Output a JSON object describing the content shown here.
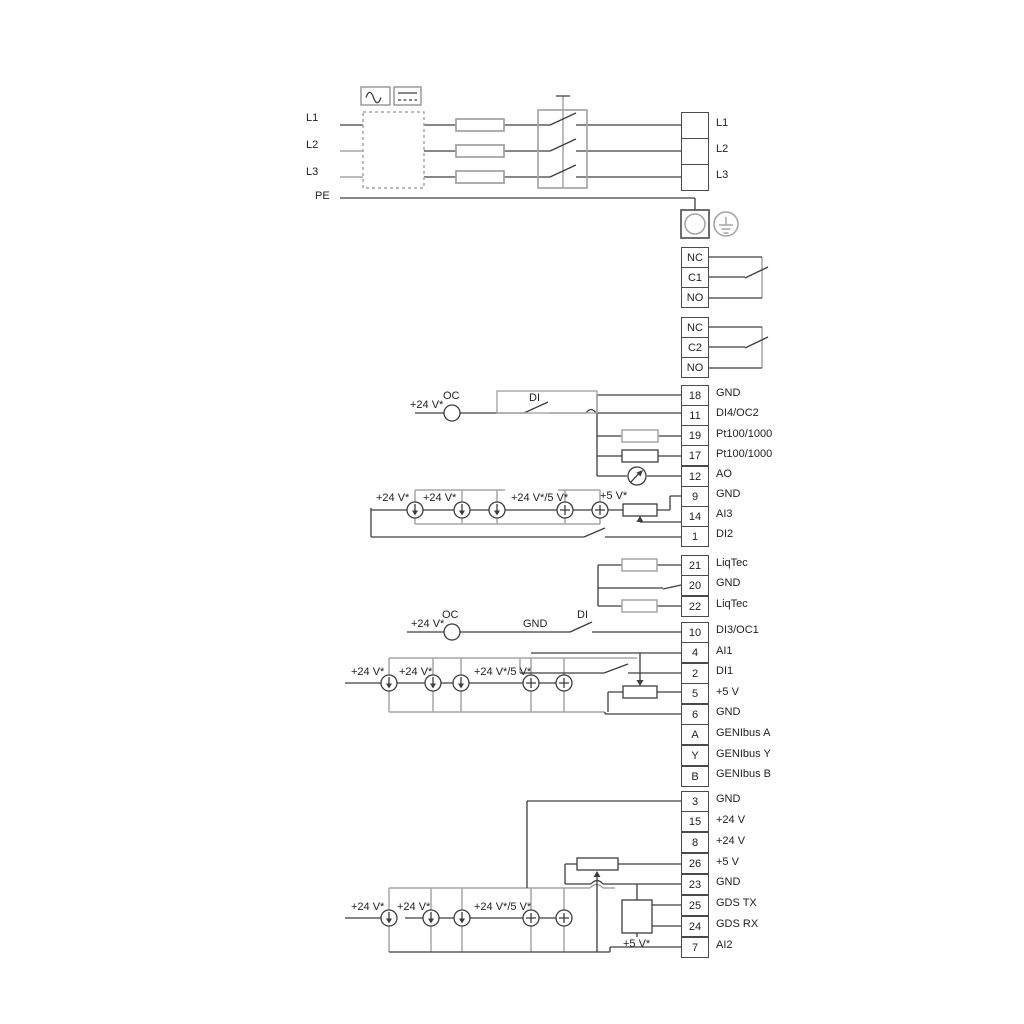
{
  "power": {
    "inputs": [
      "L1",
      "L2",
      "L3",
      "PE"
    ],
    "outputs": [
      "L1",
      "L2",
      "L3"
    ]
  },
  "relays": {
    "block1": [
      "NC",
      "C1",
      "NO"
    ],
    "block2": [
      "NC",
      "C2",
      "NO"
    ]
  },
  "terminals": {
    "group1": [
      {
        "num": "18",
        "label": "GND"
      },
      {
        "num": "11",
        "label": "DI4/OC2"
      },
      {
        "num": "19",
        "label": "Pt100/1000"
      },
      {
        "num": "17",
        "label": "Pt100/1000"
      },
      {
        "num": "12",
        "label": "AO"
      },
      {
        "num": "9",
        "label": "GND"
      },
      {
        "num": "14",
        "label": "AI3"
      },
      {
        "num": "1",
        "label": "DI2"
      }
    ],
    "liqtec": [
      {
        "num": "21",
        "label": "LiqTec"
      },
      {
        "num": "20",
        "label": "GND"
      },
      {
        "num": "22",
        "label": "LiqTec"
      }
    ],
    "group2": [
      {
        "num": "10",
        "label": "DI3/OC1"
      },
      {
        "num": "4",
        "label": "AI1"
      },
      {
        "num": "2",
        "label": "DI1"
      },
      {
        "num": "5",
        "label": "+5 V"
      },
      {
        "num": "6",
        "label": "GND"
      },
      {
        "num": "A",
        "label": "GENIbus A"
      },
      {
        "num": "Y",
        "label": "GENIbus Y"
      },
      {
        "num": "B",
        "label": "GENIbus B"
      }
    ],
    "group3": [
      {
        "num": "3",
        "label": "GND"
      },
      {
        "num": "15",
        "label": "+24 V"
      },
      {
        "num": "8",
        "label": "+24 V"
      },
      {
        "num": "26",
        "label": "+5 V"
      },
      {
        "num": "23",
        "label": "GND"
      },
      {
        "num": "25",
        "label": "GDS TX"
      },
      {
        "num": "24",
        "label": "GDS RX"
      },
      {
        "num": "7",
        "label": "AI2"
      }
    ]
  },
  "annotations": {
    "section1": {
      "v24": "+24 V*",
      "oc": "OC",
      "di": "DI",
      "src1": "+24 V*",
      "src2": "+24 V*",
      "src45": "+24 V*/5 V*",
      "v5": "+5 V*"
    },
    "section2": {
      "v24": "+24 V*",
      "oc": "OC",
      "gnd": "GND",
      "di": "DI",
      "src1": "+24 V*",
      "src2": "+24 V*",
      "src45": "+24 V*/5 V*"
    },
    "section3": {
      "src1": "+24 V*",
      "src2": "+24 V*",
      "src45": "+24 V*/5 V*",
      "v5": "+5 V*"
    }
  },
  "colors": {
    "wire_dark": "#3d3d3d",
    "wire_gray": "#a6a6a6"
  }
}
